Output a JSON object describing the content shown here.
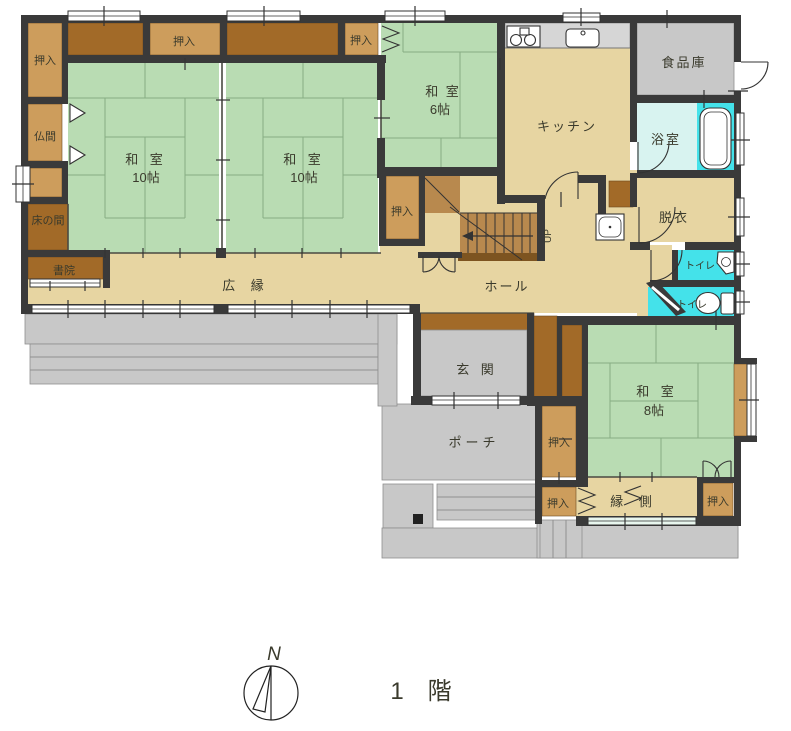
{
  "title": {
    "floor_label": "1　階",
    "compass_north": "N",
    "stairs_up": "UP"
  },
  "rooms": {
    "washitsu_nw": {
      "name": "和  室",
      "size": "10帖"
    },
    "washitsu_n": {
      "name": "和  室",
      "size": "10帖"
    },
    "washitsu_ne": {
      "name": "和  室",
      "size": "6帖"
    },
    "washitsu_se": {
      "name": "和  室",
      "size": "8帖"
    },
    "kitchen": {
      "name": "キッチン"
    },
    "pantry": {
      "name": "食品庫"
    },
    "bathroom": {
      "name": "浴室"
    },
    "dressing": {
      "name": "脱衣"
    },
    "toilet_a": {
      "name": "トイレ"
    },
    "toilet_b": {
      "name": "トイレ"
    },
    "hall": {
      "name": "ホール"
    },
    "entrance": {
      "name": "玄  関"
    },
    "porch": {
      "name": "ポーチ"
    },
    "hiroen": {
      "name": "広  縁"
    },
    "engawa": {
      "name": "縁  側"
    },
    "butsuma": {
      "name": "仏間"
    },
    "tokonoma": {
      "name": "床の間"
    },
    "shoin": {
      "name": "書院"
    },
    "closet": {
      "name": "押入"
    }
  },
  "colors": {
    "wall": "#3a3a3a",
    "tatami": "#b9dcb3",
    "beige": "#e7d5a2",
    "tan": "#cd9d5c",
    "brown": "#a26a28",
    "brown_mid": "#b8894e",
    "brown_step": "#7d5420",
    "gray": "#c8c8c8",
    "counter": "#d6d6d6",
    "bath_pale": "#d8f3f0",
    "cyan": "#44e2ea",
    "window_glass": "#e8f6ee"
  }
}
